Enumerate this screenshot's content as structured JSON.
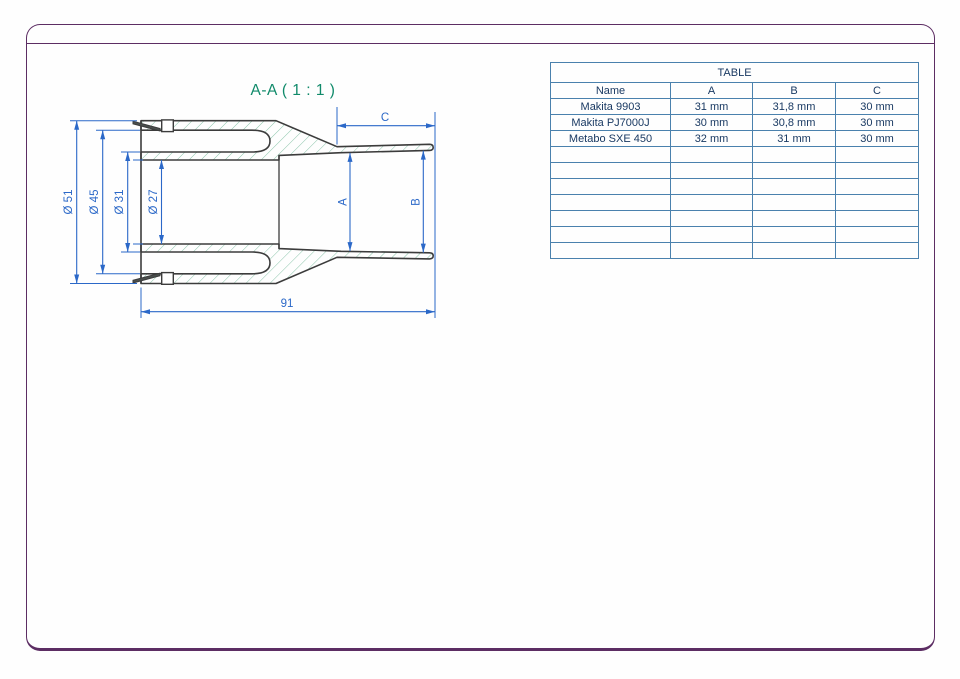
{
  "sheet": {
    "frame_color": "#5c2d63",
    "background_color": "#ffffff"
  },
  "drawing": {
    "title": "A-A ( 1 : 1 )",
    "title_color": "#108a6a",
    "outline_color": "#3c3c3c",
    "hatch_color": "#8cc5ab",
    "dimension_color": "#2b68c8",
    "dimensions": {
      "outer_flange_diameter": "Ø 51",
      "outer_body_diameter": "Ø 45",
      "sleeve_diameter": "Ø 31",
      "bore_diameter": "Ø 27",
      "overall_length": "91",
      "nozzle_bore_front": "A",
      "nozzle_bore_end": "B",
      "nozzle_length": "C"
    }
  },
  "table": {
    "title": "TABLE",
    "border_color": "#4a81ad",
    "text_color": "#1a3a63",
    "headers": [
      "Name",
      "A",
      "B",
      "C"
    ],
    "rows": [
      [
        "Makita 9903",
        "31 mm",
        "31,8 mm",
        "30 mm"
      ],
      [
        "Makita PJ7000J",
        "30 mm",
        "30,8 mm",
        "30 mm"
      ],
      [
        "Metabo SXE 450",
        "32 mm",
        "31 mm",
        "30 mm"
      ]
    ],
    "empty_row_count": 7
  }
}
